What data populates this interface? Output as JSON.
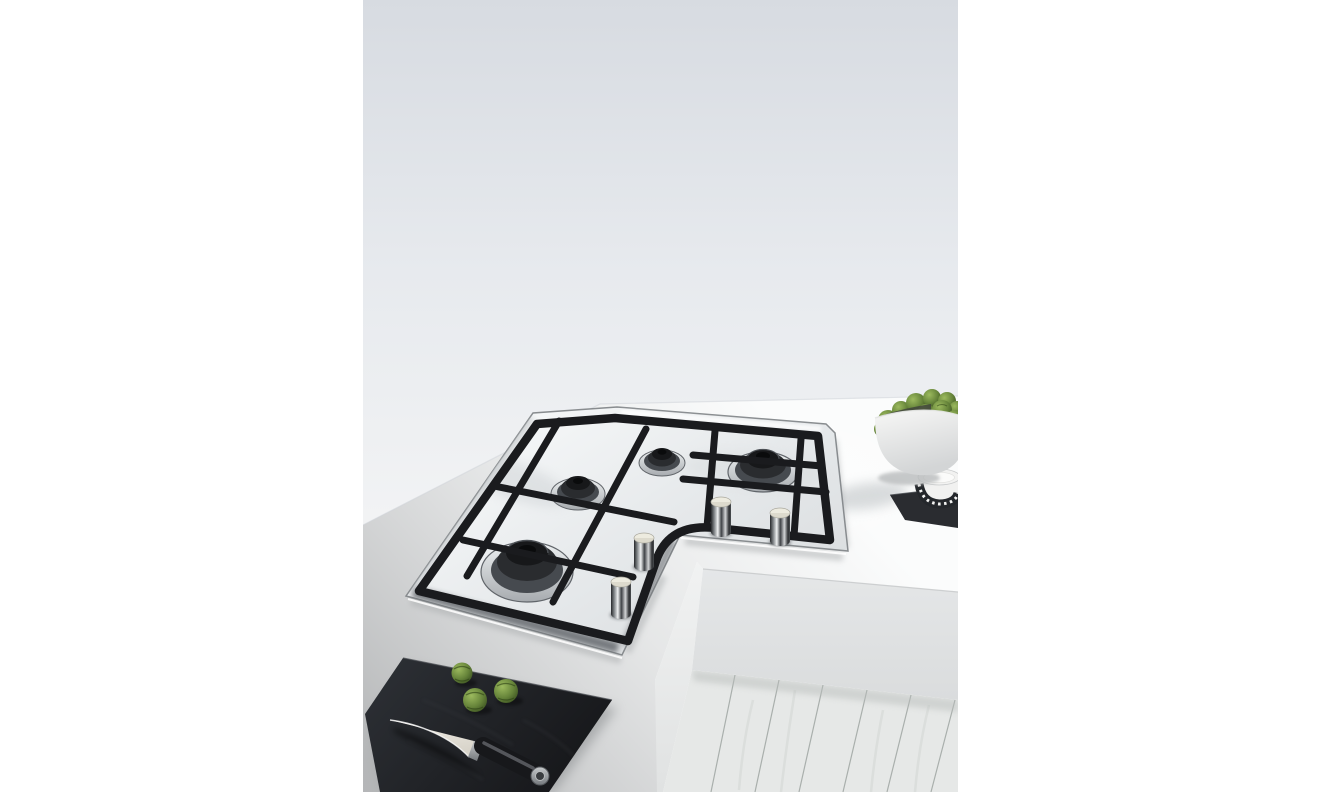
{
  "scene": {
    "description": "Kitchen photograph of an L-shaped stainless steel corner gas hob set into a white worktop, seen from above. A white bowl piled with brussels sprouts and a small patterned salt bowl on a slate coaster sit at the top right; a black slate board with three brussels sprouts and a chef's knife lies at the bottom left; whitewashed wood plank flooring shows in the bottom-right corner.",
    "objects": [
      {
        "name": "wall",
        "description": "Plain light grey wall"
      },
      {
        "name": "countertop",
        "description": "White kitchen worktop"
      },
      {
        "name": "corner-gas-hob",
        "description": "L-shaped stainless steel corner gas hob"
      },
      {
        "name": "pan-supports",
        "description": "Black cast iron pan supports with curved inner corner"
      },
      {
        "name": "burner-large-front",
        "description": "Large gas burner, front of left arm"
      },
      {
        "name": "burner-medium-left",
        "description": "Medium gas burner, left arm"
      },
      {
        "name": "burner-small-centre",
        "description": "Small gas burner at the corner"
      },
      {
        "name": "burner-large-right",
        "description": "Large gas burner, right arm"
      },
      {
        "name": "control-knobs",
        "description": "Four stainless steel control knobs along the inner corner"
      },
      {
        "name": "sprouts-bowl",
        "description": "White ceramic bowl piled with brussels sprouts"
      },
      {
        "name": "salt-bowl",
        "description": "Small white bowl with black patterned band holding salt"
      },
      {
        "name": "slate-coaster",
        "description": "Dark slate coaster under the salt bowl"
      },
      {
        "name": "slate-board",
        "description": "Black slate serving board"
      },
      {
        "name": "board-sprouts",
        "description": "Three brussels sprouts on the slate board"
      },
      {
        "name": "chefs-knife",
        "description": "Chef's knife with pale blade and black handle"
      },
      {
        "name": "counter-front-panels",
        "description": "White counter front panels at the inner corner"
      },
      {
        "name": "wood-floor",
        "description": "Whitewashed wood plank floor"
      }
    ]
  },
  "palette": {
    "page-bg": "#ffffff",
    "wall-top": "#d7dbe1",
    "wall-mid": "#e7eaee",
    "wall-bottom": "#f3f4f5",
    "counter-bright": "#fbfcfc",
    "counter-shadow": "#8a8c8e",
    "hob-steel-light": "#f4f6f7",
    "hob-steel-mid": "#e6e9eb",
    "hob-steel-dark": "#dcdfe1",
    "hob-edge": "#888c8f",
    "grate-black": "#1a1b1e",
    "burner-chrome": "#eef1f2",
    "burner-dark": "#2a2c2f",
    "knob-cap": "#edebdf",
    "sprout-light": "#9cba5e",
    "sprout-green": "#66843a",
    "sprout-dark": "#34491d",
    "bowl-white": "#f7f7f6",
    "bowl-shade": "#d3d5d6",
    "salt-pattern": "#24272b",
    "salt-white": "#fbfbfa",
    "slate-dark": "#17181b",
    "slate-mat": "#2a2c30",
    "blade-white": "#f2efe7",
    "handle-black": "#17181b",
    "steel-trim": "#c6c9cb",
    "face-light": "#f1f2f2",
    "face-grey": "#dadcdd",
    "floor-plank": "#e6e8e7",
    "floor-seam": "#9aa09d"
  }
}
